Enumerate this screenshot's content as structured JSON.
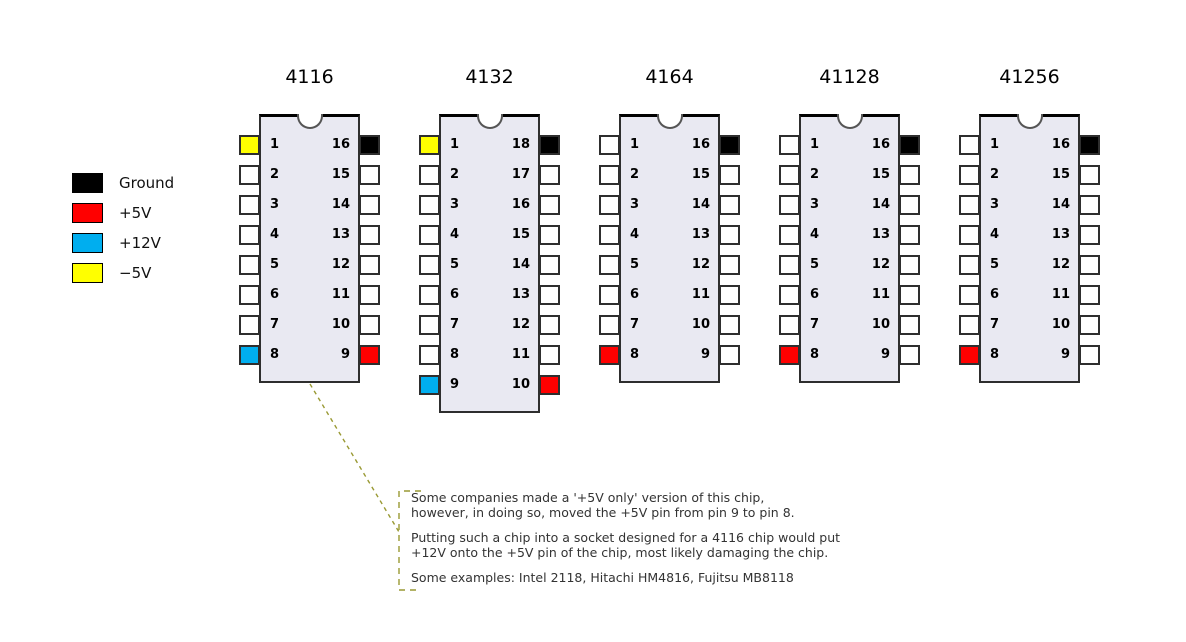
{
  "colors": {
    "ground": "#000000",
    "plus5v": "#FF0000",
    "plus12v": "#00AEEF",
    "minus5v": "#FFFF00",
    "pin_default": "#FFFFFF",
    "chip_body": "#E9E9F2",
    "annotation_accent": "#999933",
    "annotation_text": "#333333"
  },
  "legend": {
    "items": [
      {
        "name": "ground",
        "color": "#000000",
        "label": "Ground"
      },
      {
        "name": "plus5v",
        "color": "#FF0000",
        "label": "+5V"
      },
      {
        "name": "plus12v",
        "color": "#00AEEF",
        "label": "+12V"
      },
      {
        "name": "minus5v",
        "color": "#FFFF00",
        "label": "−5V"
      }
    ]
  },
  "chips": [
    {
      "title": "4116",
      "left_pins": [
        {
          "num": "1",
          "role": "minus5v"
        },
        {
          "num": "2"
        },
        {
          "num": "3"
        },
        {
          "num": "4"
        },
        {
          "num": "5"
        },
        {
          "num": "6"
        },
        {
          "num": "7"
        },
        {
          "num": "8",
          "role": "plus12v"
        }
      ],
      "right_pins": [
        {
          "num": "16",
          "role": "ground"
        },
        {
          "num": "15"
        },
        {
          "num": "14"
        },
        {
          "num": "13"
        },
        {
          "num": "12"
        },
        {
          "num": "11"
        },
        {
          "num": "10"
        },
        {
          "num": "9",
          "role": "plus5v"
        }
      ]
    },
    {
      "title": "4132",
      "left_pins": [
        {
          "num": "1",
          "role": "minus5v"
        },
        {
          "num": "2"
        },
        {
          "num": "3"
        },
        {
          "num": "4"
        },
        {
          "num": "5"
        },
        {
          "num": "6"
        },
        {
          "num": "7"
        },
        {
          "num": "8"
        },
        {
          "num": "9",
          "role": "plus12v"
        }
      ],
      "right_pins": [
        {
          "num": "18",
          "role": "ground"
        },
        {
          "num": "17"
        },
        {
          "num": "16"
        },
        {
          "num": "15"
        },
        {
          "num": "14"
        },
        {
          "num": "13"
        },
        {
          "num": "12"
        },
        {
          "num": "11"
        },
        {
          "num": "10",
          "role": "plus5v"
        }
      ]
    },
    {
      "title": "4164",
      "left_pins": [
        {
          "num": "1"
        },
        {
          "num": "2"
        },
        {
          "num": "3"
        },
        {
          "num": "4"
        },
        {
          "num": "5"
        },
        {
          "num": "6"
        },
        {
          "num": "7"
        },
        {
          "num": "8",
          "role": "plus5v"
        }
      ],
      "right_pins": [
        {
          "num": "16",
          "role": "ground"
        },
        {
          "num": "15"
        },
        {
          "num": "14"
        },
        {
          "num": "13"
        },
        {
          "num": "12"
        },
        {
          "num": "11"
        },
        {
          "num": "10"
        },
        {
          "num": "9"
        }
      ]
    },
    {
      "title": "41128",
      "left_pins": [
        {
          "num": "1"
        },
        {
          "num": "2"
        },
        {
          "num": "3"
        },
        {
          "num": "4"
        },
        {
          "num": "5"
        },
        {
          "num": "6"
        },
        {
          "num": "7"
        },
        {
          "num": "8",
          "role": "plus5v"
        }
      ],
      "right_pins": [
        {
          "num": "16",
          "role": "ground"
        },
        {
          "num": "15"
        },
        {
          "num": "14"
        },
        {
          "num": "13"
        },
        {
          "num": "12"
        },
        {
          "num": "11"
        },
        {
          "num": "10"
        },
        {
          "num": "9"
        }
      ]
    },
    {
      "title": "41256",
      "left_pins": [
        {
          "num": "1"
        },
        {
          "num": "2"
        },
        {
          "num": "3"
        },
        {
          "num": "4"
        },
        {
          "num": "5"
        },
        {
          "num": "6"
        },
        {
          "num": "7"
        },
        {
          "num": "8",
          "role": "plus5v"
        }
      ],
      "right_pins": [
        {
          "num": "16",
          "role": "ground"
        },
        {
          "num": "15"
        },
        {
          "num": "14"
        },
        {
          "num": "13"
        },
        {
          "num": "12"
        },
        {
          "num": "11"
        },
        {
          "num": "10"
        },
        {
          "num": "9"
        }
      ]
    }
  ],
  "annotation": {
    "paragraphs": [
      [
        "Some companies made a '+5V only' version of this chip,",
        "however, in doing so, moved the +5V pin from pin 9 to pin 8."
      ],
      [
        "Putting such a chip into a socket designed for a 4116 chip would put",
        "+12V onto the +5V pin of the chip, most likely damaging the chip."
      ],
      [
        "Some examples: Intel 2118, Hitachi HM4816, Fujitsu MB8118"
      ]
    ]
  }
}
